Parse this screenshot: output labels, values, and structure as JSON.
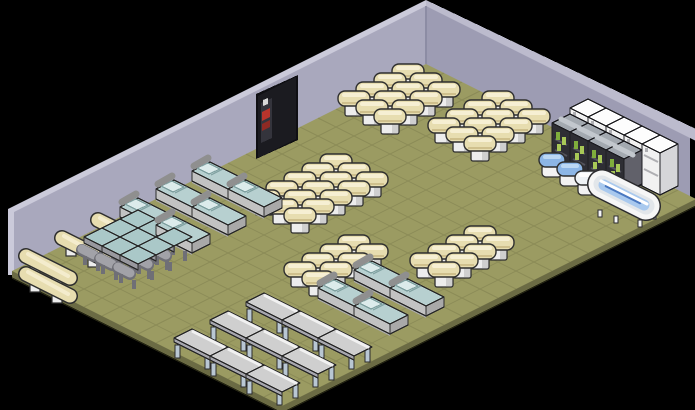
{
  "scene": {
    "title": "isometric-room",
    "width": 695,
    "height": 410,
    "background": "#000000"
  },
  "room": {
    "origin": {
      "x": 426,
      "y": 64
    },
    "tile": {
      "half_w": 18,
      "half_h": 9,
      "cols": 15,
      "rows": 23
    },
    "wall": {
      "peak": {
        "x": 426,
        "y": 6
      },
      "height": 58,
      "left_face": "#a9a8bd",
      "right_face": "#9d9cb3",
      "edge_light_left": "#cbcada",
      "edge_light_right": "#bcbbcd",
      "corner_shade": "#8c8ca4",
      "outline": "#2a2a33"
    },
    "floor": {
      "fill": "#9b9b62",
      "grid": "#8b8b57",
      "edge": "#6b6b44",
      "edge_outline": "#232312"
    }
  },
  "door": {
    "x1": 258,
    "x2": 296,
    "top_offset": 6,
    "bottom_drop": 11,
    "fill": "#1b1b20",
    "frame": "#0f0f13",
    "accent_red": "#b9342c",
    "accent_red_dark": "#8e2a24",
    "accent_light": "#d8d8d8",
    "inner_panel": "#34343c"
  },
  "palette": {
    "stool": {
      "cap": "#e7ddb0",
      "cap_hi": "#f6efd3",
      "cap_shade": "#cfc08d",
      "base": "#ededed",
      "base_side": "#cfcfcf",
      "outline": "#2e2e2e"
    },
    "bench": {
      "cap": "#e7ddb0",
      "cap_hi": "#f4eccd",
      "base": "#ededed",
      "outline": "#2e2e2e"
    },
    "bed": {
      "top": "#b7d0d0",
      "pillow": "#dcebeb",
      "seam": "#7fa0a0",
      "frame": "#8f8f8f",
      "side": "#c2c2c2",
      "side2": "#a9a9a9",
      "outline": "#2c2c2c"
    },
    "deskchair": {
      "desk_top": "#aac8c8",
      "desk_front": "#98989e",
      "chair": "#a2a2a8",
      "chair_dark": "#6f6f76",
      "outline": "#2c2c2c"
    },
    "table": {
      "top": "#cfcfcf",
      "hi": "#f1f1f1",
      "front": "#a6a6ad",
      "leg": "#b9c7d3",
      "outline": "#2b2b2b"
    },
    "fridge": {
      "top": "#fdfdfd",
      "front": "#f1f1f1",
      "side": "#d6d6d9",
      "detail": "#aeaeb2",
      "outline": "#232326"
    },
    "minibar": {
      "top": "#a3a9b0",
      "front": "#2e2e34",
      "side": "#61616a",
      "bottle1": "#7fae3c",
      "bottle2": "#a8c857",
      "shelf": "#54545c",
      "outline": "#1d1d22"
    },
    "toilet": {
      "base": "#f2f2f2",
      "outline": "#2d2d2d",
      "hi_blue": "#bcd8f4",
      "hi_white": "#ffffff"
    },
    "bathtub": {
      "body": "#f6f6f6",
      "rim": "#e2e6ea",
      "water": "#a9c9ee",
      "water_line": "#4a78c0",
      "outline": "#2b2b2e"
    }
  },
  "furniture": {
    "groups": [
      {
        "id": "stool-bank-top-a",
        "type": "stool",
        "label": "cream stool bank",
        "grid": {
          "c0": 0,
          "r0": 1,
          "cols": 3,
          "rows": 4
        }
      },
      {
        "id": "stool-bank-top-b",
        "type": "stool",
        "label": "cream stool bank",
        "grid": {
          "c0": 4,
          "r0": 0,
          "cols": 3,
          "rows": 4
        }
      },
      {
        "id": "stool-bank-center",
        "type": "stool",
        "label": "cream stool bank",
        "grid": {
          "c0": 3,
          "r0": 8,
          "cols": 3,
          "rows": 5
        }
      },
      {
        "id": "stool-bank-right-w",
        "type": "stool",
        "label": "cream stool bank",
        "grid": {
          "c0": 8,
          "r0": 12,
          "cols": 2,
          "rows": 4
        }
      },
      {
        "id": "stool-bank-right-e",
        "type": "stool",
        "label": "cream stool bank",
        "grid": {
          "c0": 11,
          "r0": 8,
          "cols": 2,
          "rows": 4
        }
      },
      {
        "id": "bench-stack-left",
        "type": "bench",
        "label": "cream bench stack",
        "tiles": [
          [
            0,
            17
          ],
          [
            0,
            19
          ],
          [
            0,
            21
          ],
          [
            1,
            22
          ]
        ]
      },
      {
        "id": "bed-block-center",
        "type": "bed",
        "label": "beds pale blue",
        "tiles": [
          [
            0,
            12
          ],
          [
            2,
            12
          ],
          [
            0,
            14
          ],
          [
            2,
            14
          ],
          [
            0,
            16
          ],
          [
            2,
            16
          ]
        ]
      },
      {
        "id": "bed-block-right",
        "type": "bed",
        "label": "beds pale blue",
        "tiles": [
          [
            10,
            13
          ],
          [
            12,
            13
          ],
          [
            10,
            15
          ],
          [
            12,
            15
          ]
        ]
      },
      {
        "id": "desk-combo-block",
        "type": "deskchair",
        "label": "school desk and chair",
        "grid": {
          "c0": 1,
          "r0": 17,
          "cols": 3,
          "rows": 3
        }
      },
      {
        "id": "table-rows-bottom",
        "type": "table",
        "label": "gray tables",
        "tiles": [
          [
            9,
            18
          ],
          [
            11,
            18
          ],
          [
            13,
            18
          ],
          [
            9,
            20
          ],
          [
            11,
            20
          ],
          [
            13,
            20
          ],
          [
            9,
            22
          ],
          [
            11,
            22
          ],
          [
            13,
            22
          ]
        ]
      },
      {
        "id": "fridge-row",
        "type": "fridge",
        "label": "white fridges",
        "grid": {
          "c0": 9,
          "r0": 0,
          "cols": 5,
          "rows": 1
        }
      },
      {
        "id": "minibar-row",
        "type": "minibar",
        "label": "open drink cabinets",
        "grid": {
          "c0": 9,
          "r0": 1,
          "cols": 4,
          "rows": 1
        }
      },
      {
        "id": "toilet-row",
        "type": "toilet",
        "label": "toilets",
        "tiles": [
          [
            9,
            2
          ],
          [
            10,
            2
          ],
          [
            11,
            2
          ]
        ],
        "lids": [
          "#8cb6e6",
          "#8cb6e6",
          "#eff3f6"
        ]
      },
      {
        "id": "bathtub",
        "type": "bathtub",
        "label": "clawfoot bathtub",
        "tiles": [
          [
            12,
            2
          ]
        ]
      }
    ]
  }
}
